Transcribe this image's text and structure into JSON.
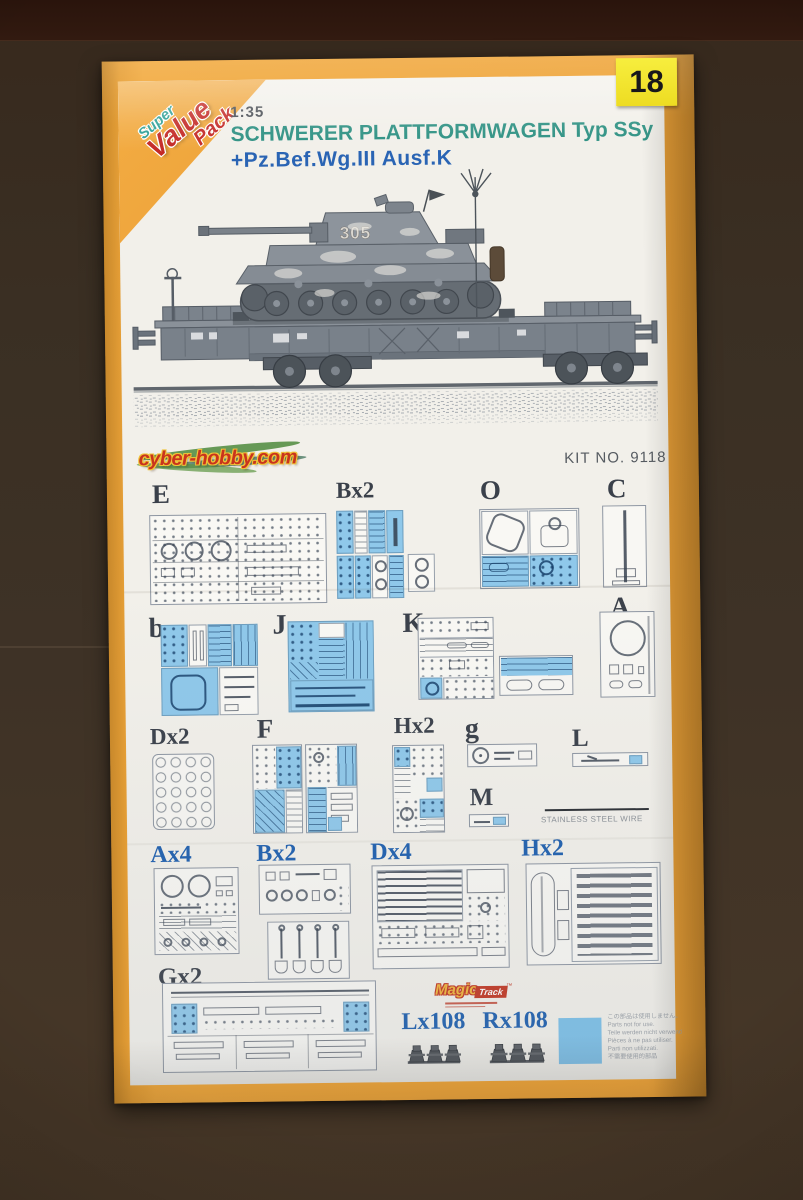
{
  "scene": {
    "sticker_number": "18"
  },
  "badge": {
    "word1": "Super",
    "word2": "Value",
    "word3": "Pack"
  },
  "header": {
    "scale": "1:35",
    "title_line1": "SCHWERER PLATTFORMWAGEN Typ SSy",
    "title_line2": "+Pz.Bef.Wg.III Ausf.K"
  },
  "illustration": {
    "turret_number": "305"
  },
  "branding": {
    "site": "cyber-hobby.com",
    "kit_no": "KIT NO. 9118"
  },
  "sprues": {
    "e": "E",
    "bx2_gray": "Bx2",
    "o": "O",
    "c": "C",
    "b": "b",
    "j": "J",
    "k": "K",
    "a": "A",
    "dx2": "Dx2",
    "f": "F",
    "hx2_gray": "Hx2",
    "g": "g",
    "l": "L",
    "m": "M",
    "ax4": "Ax4",
    "bx2_blue": "Bx2",
    "dx4": "Dx4",
    "hx2_blue": "Hx2",
    "gx2": "Gx2"
  },
  "wire": {
    "label": "STAINLESS STEEL WIRE"
  },
  "magic_track": {
    "name_italic": "Magic",
    "name_box": "Track",
    "trademark": "™"
  },
  "tracks": {
    "left_label": "Lx108",
    "right_label": "Rx108"
  },
  "not_for_use": {
    "line_jp": "この部品は使用しません。",
    "line_en": "Parts not for use.",
    "line_de": "Teile werden nicht verwendet.",
    "line_fr": "Pièces à ne pas utiliser.",
    "line_it": "Parti non utilizzati.",
    "line_cn": "不需要使用的部品"
  },
  "colors": {
    "border_orange": "#efa63d",
    "sprue_blue": "#8fc8ea",
    "label_blue": "#1e5fae",
    "label_dark": "#3a404a",
    "title_teal": "#2e9183",
    "title_blue": "#2a64b4",
    "sticker_yellow": "#f2e429",
    "logo_red": "#c9341d",
    "badge_red": "#c42a26",
    "badge_teal": "#2fa096"
  }
}
